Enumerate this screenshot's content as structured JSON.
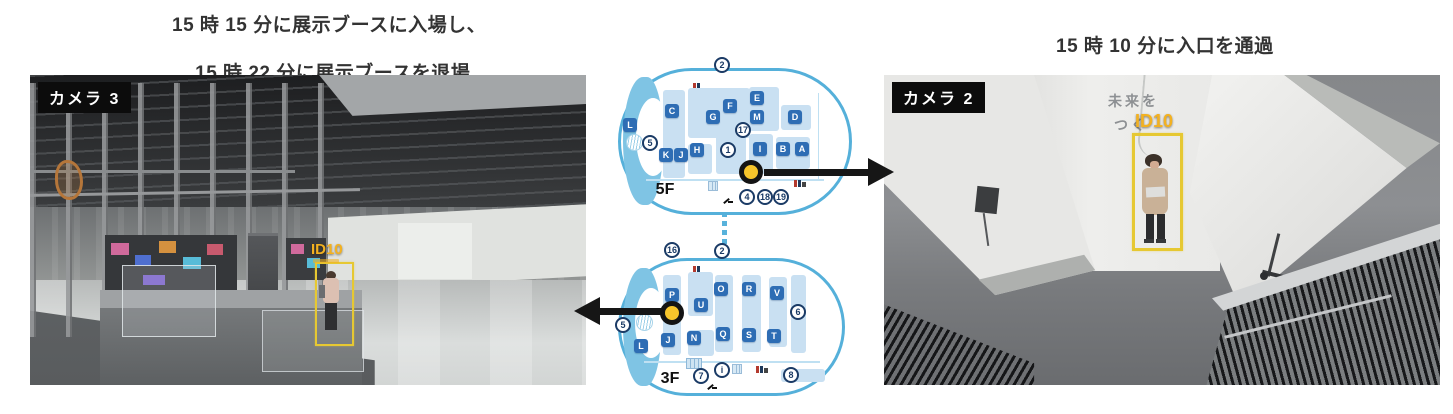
{
  "captions": {
    "camera3_line1": "15 時 15 分に展示ブースに入場し、",
    "camera3_line2": "15 時 22 分に展示ブースを退場",
    "camera2": "15 時 10 分に入口を通過"
  },
  "camera3": {
    "label": "カメラ 3",
    "track_id": "ID10"
  },
  "camera2": {
    "label": "カメラ 2",
    "track_id": "ID10",
    "wall_text_line1": "未来を",
    "wall_text_line2": "つく"
  },
  "colors": {
    "track_label_yellow": "#F3B120",
    "bbox_yellow": "#E6C832",
    "marker_yellow": "#F7C52B",
    "map_outline_blue": "#55B0DA",
    "booth_tile_blue": "#2E6DB4",
    "booth_block_blue": "#C9E0F2",
    "number_navy": "#1B3B66",
    "arrow_black": "#161616"
  },
  "map5f": {
    "floor_label": "5F",
    "blocks": [
      [
        45,
        22,
        22,
        88
      ],
      [
        70,
        20,
        62,
        50
      ],
      [
        70,
        76,
        24,
        30
      ],
      [
        98,
        66,
        30,
        40
      ],
      [
        131,
        19,
        30,
        44
      ],
      [
        163,
        37,
        30,
        25
      ],
      [
        131,
        66,
        24,
        40
      ],
      [
        158,
        69,
        34,
        32
      ]
    ],
    "booths": [
      {
        "label": "L",
        "x": 12,
        "y": 57
      },
      {
        "label": "C",
        "x": 54,
        "y": 43
      },
      {
        "label": "G",
        "x": 95,
        "y": 49
      },
      {
        "label": "F",
        "x": 112,
        "y": 38
      },
      {
        "label": "E",
        "x": 139,
        "y": 30
      },
      {
        "label": "M",
        "x": 139,
        "y": 49
      },
      {
        "label": "D",
        "x": 177,
        "y": 49
      },
      {
        "label": "K",
        "x": 48,
        "y": 87
      },
      {
        "label": "J",
        "x": 63,
        "y": 87
      },
      {
        "label": "H",
        "x": 79,
        "y": 82
      },
      {
        "label": "I",
        "x": 142,
        "y": 81
      },
      {
        "label": "B",
        "x": 165,
        "y": 81
      },
      {
        "label": "A",
        "x": 184,
        "y": 81
      }
    ],
    "numbers": [
      {
        "label": "2",
        "x": 104,
        "y": -3
      },
      {
        "label": "17",
        "x": 125,
        "y": 62
      },
      {
        "label": "1",
        "x": 110,
        "y": 82
      },
      {
        "label": "5",
        "x": 32,
        "y": 75
      },
      {
        "label": "4",
        "x": 129,
        "y": 129
      },
      {
        "label": "18",
        "x": 147,
        "y": 129
      },
      {
        "label": "19",
        "x": 163,
        "y": 129
      }
    ]
  },
  "map3f": {
    "floor_label": "3F",
    "blocks": [
      [
        45,
        17,
        18,
        80
      ],
      [
        70,
        14,
        25,
        44
      ],
      [
        97,
        17,
        18,
        77
      ],
      [
        124,
        17,
        19,
        77
      ],
      [
        151,
        19,
        18,
        70
      ],
      [
        173,
        17,
        15,
        78
      ],
      [
        163,
        111,
        44,
        13
      ],
      [
        70,
        72,
        26,
        26
      ]
    ],
    "booths": [
      {
        "label": "P",
        "x": 54,
        "y": 37
      },
      {
        "label": "O",
        "x": 103,
        "y": 31
      },
      {
        "label": "R",
        "x": 131,
        "y": 31
      },
      {
        "label": "V",
        "x": 159,
        "y": 35
      },
      {
        "label": "U",
        "x": 83,
        "y": 47
      },
      {
        "label": "L",
        "x": 23,
        "y": 88
      },
      {
        "label": "J",
        "x": 50,
        "y": 82
      },
      {
        "label": "N",
        "x": 76,
        "y": 80
      },
      {
        "label": "Q",
        "x": 105,
        "y": 76
      },
      {
        "label": "S",
        "x": 131,
        "y": 77
      },
      {
        "label": "T",
        "x": 156,
        "y": 78
      }
    ],
    "numbers": [
      {
        "label": "16",
        "x": 54,
        "y": -8
      },
      {
        "label": "2",
        "x": 104,
        "y": -7
      },
      {
        "label": "6",
        "x": 180,
        "y": 54
      },
      {
        "label": "5",
        "x": 5,
        "y": 67
      },
      {
        "label": "7",
        "x": 83,
        "y": 118
      },
      {
        "label": "i",
        "x": 104,
        "y": 112
      },
      {
        "label": "8",
        "x": 173,
        "y": 117
      }
    ]
  }
}
